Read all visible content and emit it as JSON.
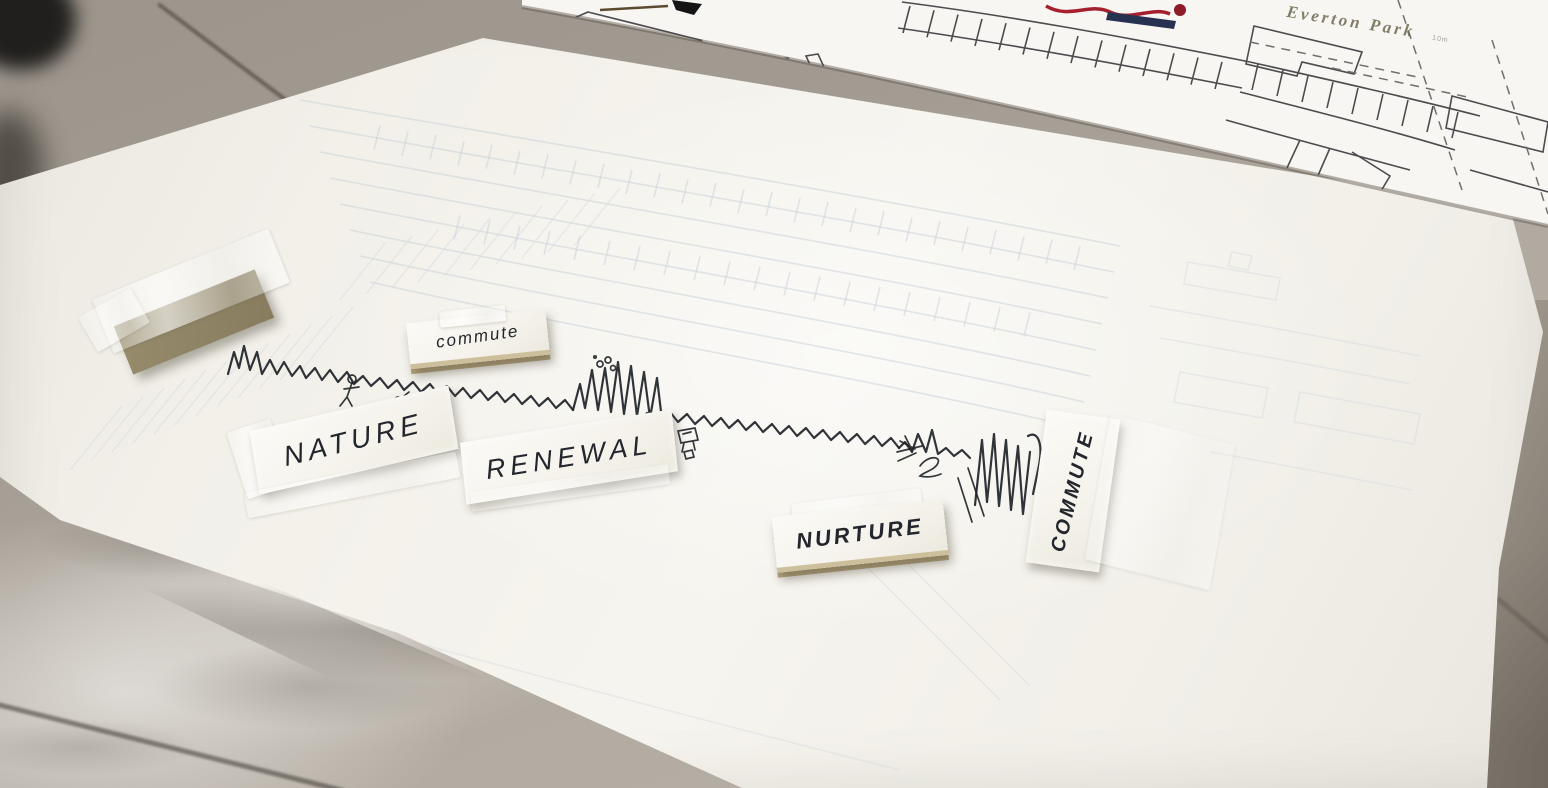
{
  "top_map_sheet": {
    "park_label": "Everton Park",
    "scale_label": "10m"
  },
  "poster_labels": {
    "commute_small": {
      "text": "commute"
    },
    "nature": {
      "text": "NATURE"
    },
    "renewal": {
      "text": "RENEWAL"
    },
    "nurture": {
      "text": "NURTURE"
    },
    "commute_vertical": {
      "text": "COMMUTE"
    },
    "folded_label": {
      "text": "COMMUTE"
    }
  },
  "sketch_icons": [
    "skyline-profile-sketch",
    "tall-towers-sketch",
    "stick-figure-icon",
    "runner-figure-icon",
    "smoke-circles-icon",
    "tent-icon",
    "cube-robot-icon",
    "spray-arrow-icon",
    "squiggle-icon"
  ],
  "colors": {
    "ink": "#1e2227",
    "poster_paper": "#f4f2ec",
    "map_paper": "#f7f6f3",
    "faint_grid": "#c7d0da",
    "map_line": "#4c4c4e",
    "map_red": "#a5202c",
    "map_navy": "#273150",
    "park_text": "#6e6950",
    "tape": "rgba(255,255,255,0.55)",
    "floor_concrete": "#a29b92",
    "floor_marble": "#c7c2bd",
    "scrap_edge_tan": "#b9a87f"
  }
}
